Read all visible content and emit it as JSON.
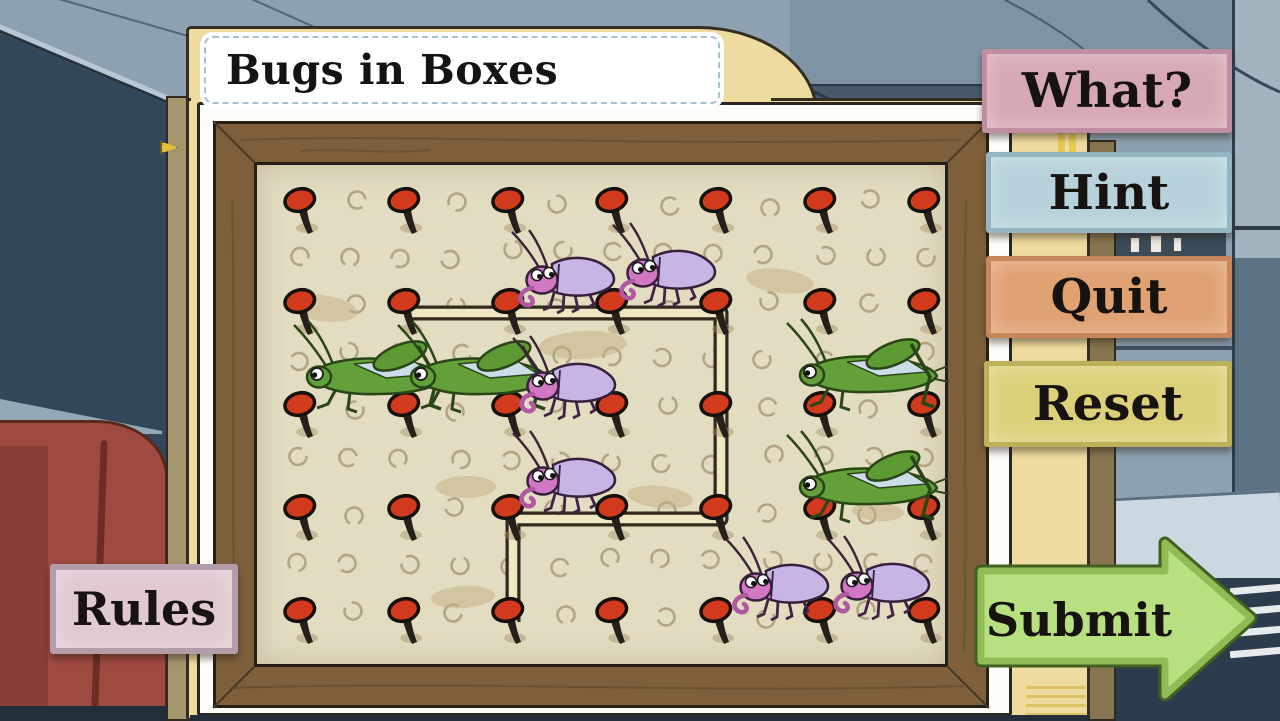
{
  "window": {
    "title_plate": "Bugs in Boxes"
  },
  "menu": {
    "what_label": "What?",
    "hint_label": "Hint",
    "quit_label": "Quit",
    "reset_label": "Reset",
    "rules_label": "Rules",
    "submit_label": "Submit"
  },
  "colors": {
    "what_bg": "#d7a9b3",
    "what_border": "#bf8ea0",
    "hint_bg": "#b7d2da",
    "hint_border": "#94b6c2",
    "quit_bg": "#e0a173",
    "quit_border": "#c8875a",
    "reset_bg": "#dcd17a",
    "reset_border": "#bcb15a",
    "rules_bg": "#e0c9d3",
    "rules_border": "#b29da8",
    "submit_fill": "#b7e080",
    "submit_mid": "#8fbc55",
    "submit_dark": "#42601f",
    "pin_red": "#d23a1e",
    "board_bg": "#e2dcc0",
    "path_fill": "#efe7c2",
    "path_edge": "#332a1f",
    "frame_wood": "#7d5f3b",
    "folder_tan": "#eedb9f",
    "page_white": "#fcfcf8",
    "hole_ring": "#b3a584",
    "smudge": "#c3ad83",
    "wall_light": "#8da1b0",
    "wall_mid": "#7e93a4",
    "wall_dark": "#33475a",
    "couch_red": "#9f4a41",
    "navy": "#2b3c4c",
    "grasshopper_green": "#64a039",
    "weevil_pink": "#d277c4",
    "weevil_shell": "#c6b5e5",
    "text_dark": "#171310"
  },
  "board": {
    "pin_columns_x": [
      300,
      404,
      508,
      612,
      716,
      820,
      924
    ],
    "pin_rows_y": [
      201,
      302,
      405,
      508,
      611
    ],
    "string_path_points": [
      [
        404,
        302
      ],
      [
        716,
        302
      ],
      [
        716,
        508
      ],
      [
        508,
        508
      ],
      [
        508,
        611
      ]
    ],
    "bugs": [
      {
        "type": "grasshopper",
        "x": 375,
        "y": 371
      },
      {
        "type": "grasshopper",
        "x": 479,
        "y": 371
      },
      {
        "type": "grasshopper",
        "x": 868,
        "y": 369
      },
      {
        "type": "grasshopper",
        "x": 868,
        "y": 481
      },
      {
        "type": "weevil",
        "x": 565,
        "y": 277
      },
      {
        "type": "weevil",
        "x": 666,
        "y": 270
      },
      {
        "type": "weevil",
        "x": 566,
        "y": 383
      },
      {
        "type": "weevil",
        "x": 566,
        "y": 478
      },
      {
        "type": "weevil",
        "x": 779,
        "y": 584
      },
      {
        "type": "weevil",
        "x": 880,
        "y": 583
      }
    ],
    "smudges": [
      [
        322,
        308,
        36,
        13
      ],
      [
        583,
        345,
        44,
        14
      ],
      [
        780,
        281,
        34,
        12
      ],
      [
        466,
        487,
        30,
        11
      ],
      [
        660,
        497,
        33,
        11
      ],
      [
        463,
        597,
        32,
        11
      ],
      [
        878,
        512,
        26,
        9
      ]
    ],
    "counts": {
      "pins": 35,
      "grasshoppers": 4,
      "weevils": 6
    }
  }
}
